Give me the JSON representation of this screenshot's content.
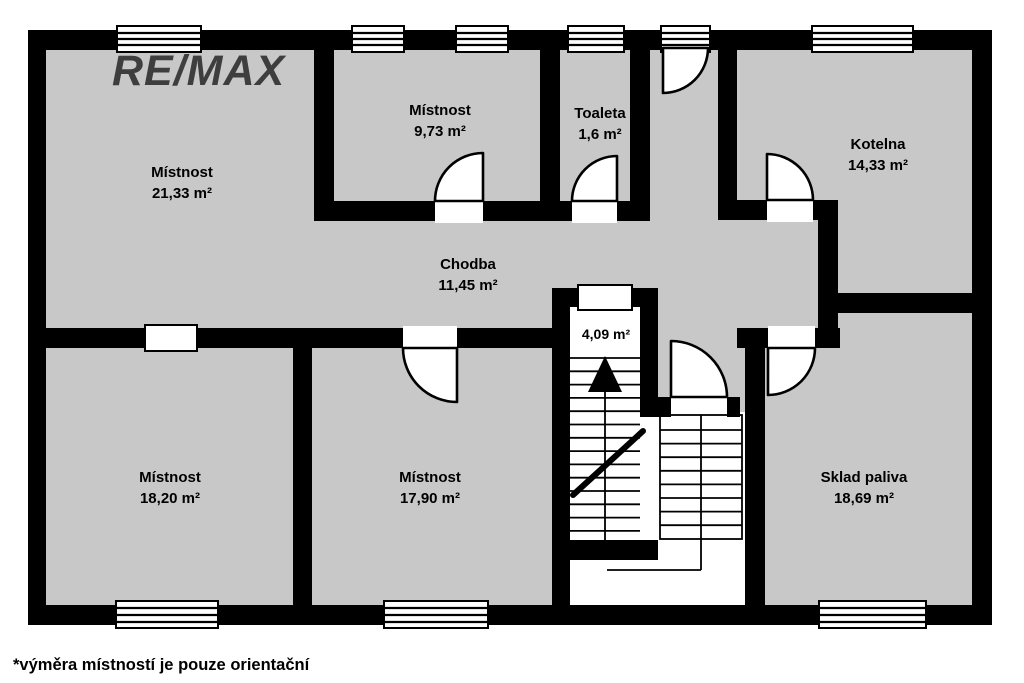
{
  "branding": {
    "logo": "RE/MAX"
  },
  "footnote": "*výměra místností je pouze orientační",
  "colors": {
    "wall": "#000000",
    "room_fill": "#c8c8c8",
    "logo_gray": "#3e3e3e",
    "label_text": "#000000"
  },
  "rooms": [
    {
      "id": "room-2133",
      "name": "Místnost",
      "area": "21,33 m²"
    },
    {
      "id": "room-973",
      "name": "Místnost",
      "area": "9,73 m²"
    },
    {
      "id": "toaleta",
      "name": "Toaleta",
      "area": "1,6 m²"
    },
    {
      "id": "kotelna",
      "name": "Kotelna",
      "area": "14,33 m²"
    },
    {
      "id": "chodba",
      "name": "Chodba",
      "area": "11,45 m²"
    },
    {
      "id": "stairwell",
      "name": "",
      "area": "4,09 m²"
    },
    {
      "id": "room-1820",
      "name": "Místnost",
      "area": "18,20 m²"
    },
    {
      "id": "room-1790",
      "name": "Místnost",
      "area": "17,90 m²"
    },
    {
      "id": "sklad",
      "name": "Sklad paliva",
      "area": "18,69 m²"
    }
  ]
}
